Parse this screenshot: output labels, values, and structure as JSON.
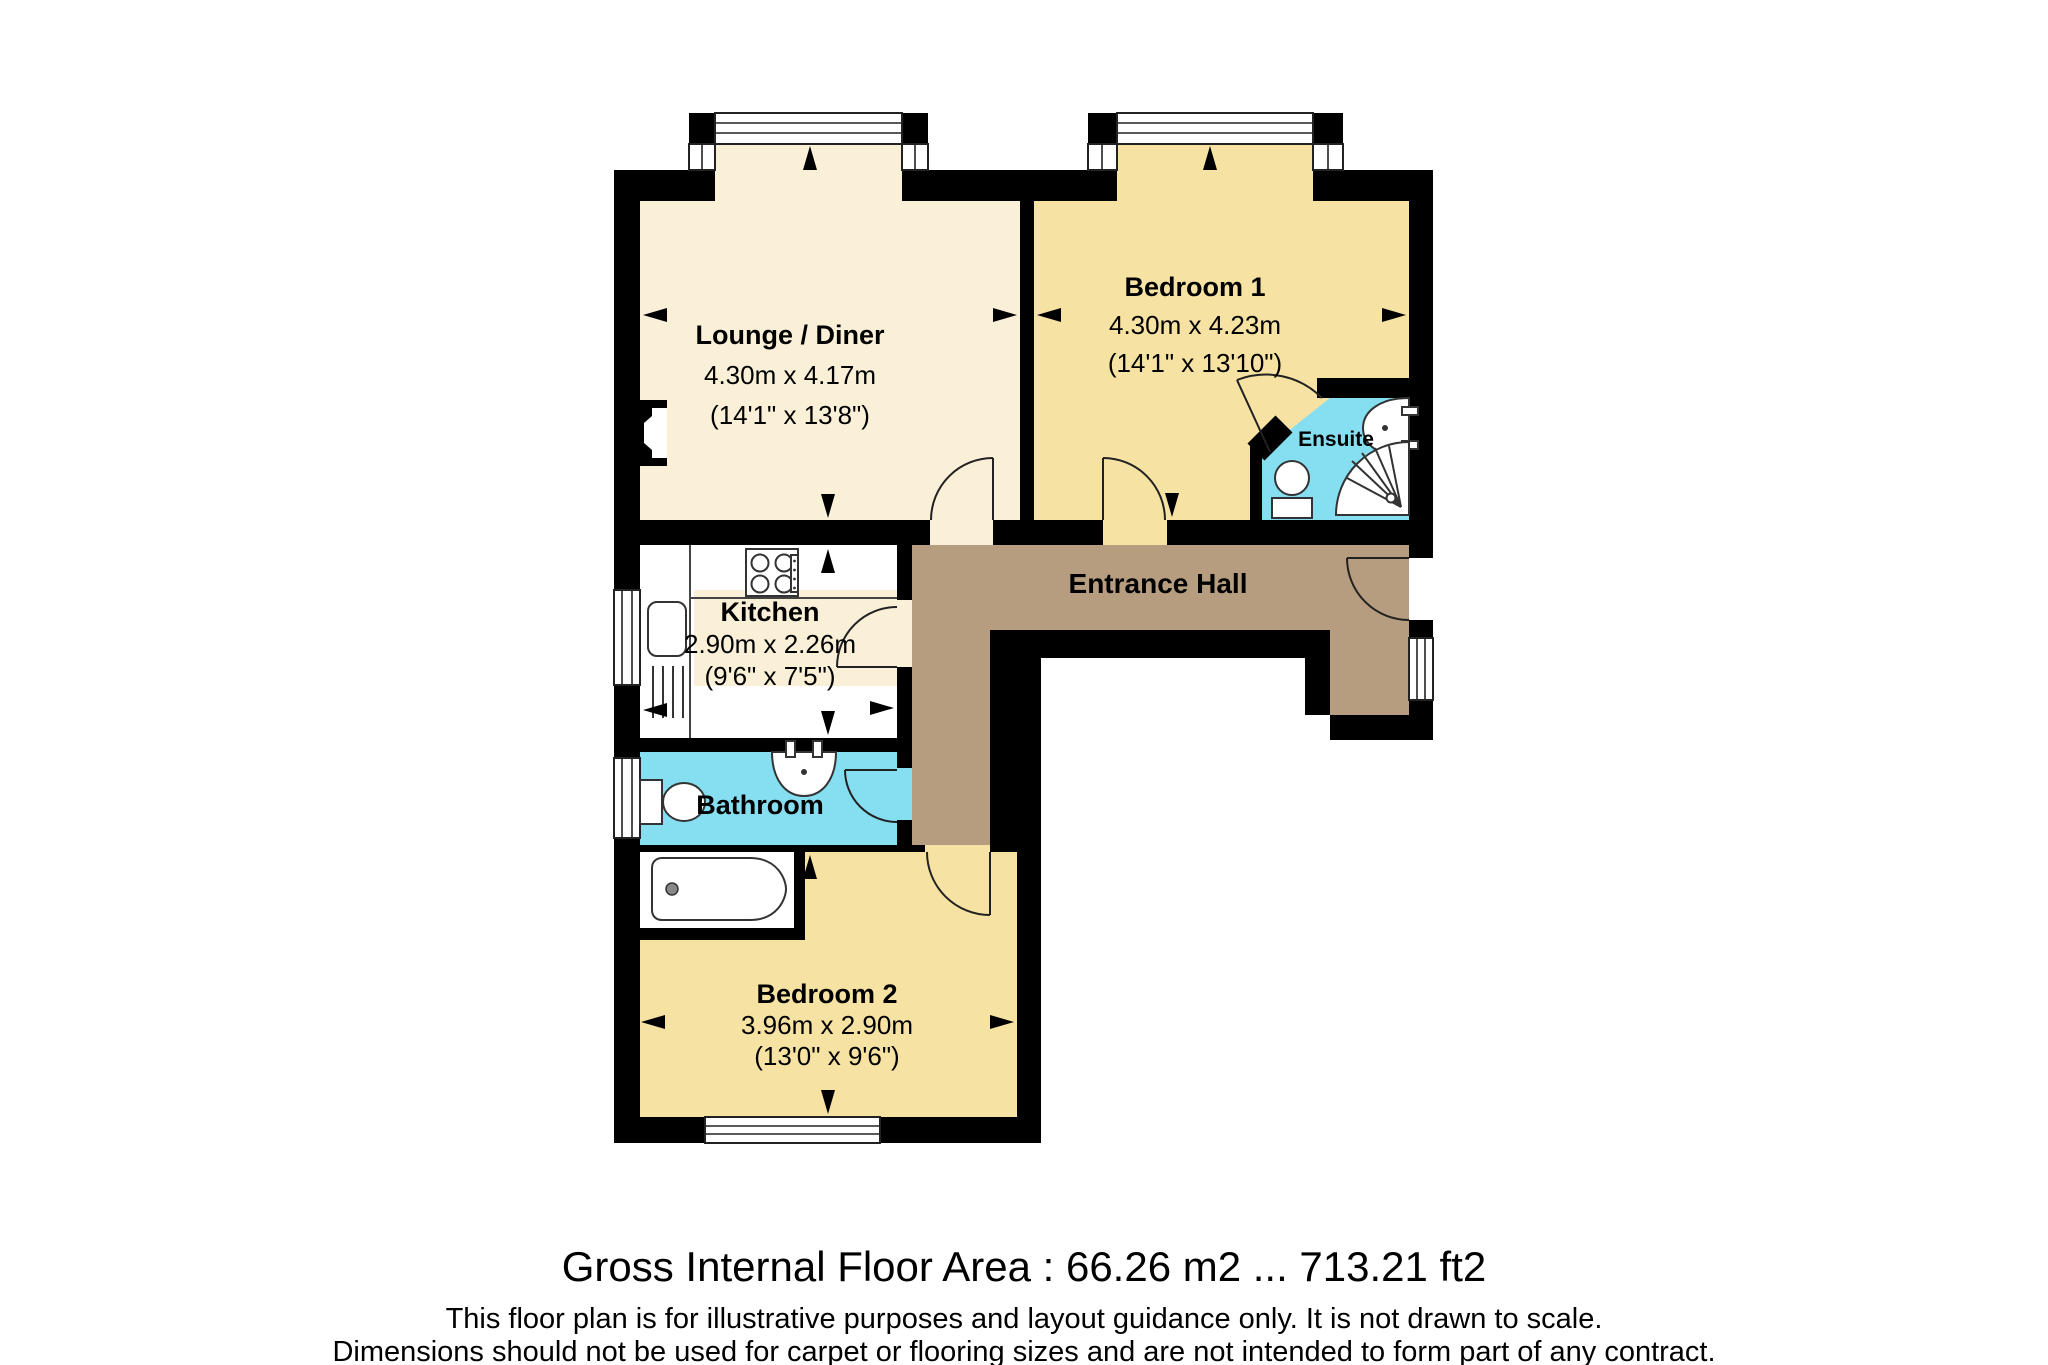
{
  "floorplan": {
    "rooms": {
      "lounge": {
        "name": "Lounge / Diner",
        "metric": "4.30m x 4.17m",
        "imperial": "(14'1\" x 13'8\")"
      },
      "bedroom1": {
        "name": "Bedroom 1",
        "metric": "4.30m x 4.23m",
        "imperial": "(14'1\" x 13'10\")"
      },
      "ensuite": {
        "name": "Ensuite"
      },
      "kitchen": {
        "name": "Kitchen",
        "metric": "2.90m x 2.26m",
        "imperial": "(9'6\" x 7'5\")"
      },
      "entrance_hall": {
        "name": "Entrance Hall"
      },
      "bathroom": {
        "name": "Bathroom"
      },
      "bedroom2": {
        "name": "Bedroom 2",
        "metric": "3.96m x 2.90m",
        "imperial": "(13'0\" x 9'6\")"
      }
    },
    "colors": {
      "cream": "#FAF0D8",
      "wheat": "#F6E2A2",
      "cyan": "#86DFF1",
      "brown": "#B79D7F",
      "wall": "#000000",
      "white": "#FFFFFF"
    },
    "footer": {
      "title": "Gross Internal Floor Area : 66.26 m2 ... 713.21 ft2",
      "disclaimer1": "This floor plan is for illustrative purposes and layout guidance only. It is not drawn to scale.",
      "disclaimer2": "Dimensions should not be used for carpet or flooring sizes and are not intended to form part of any contract."
    }
  }
}
